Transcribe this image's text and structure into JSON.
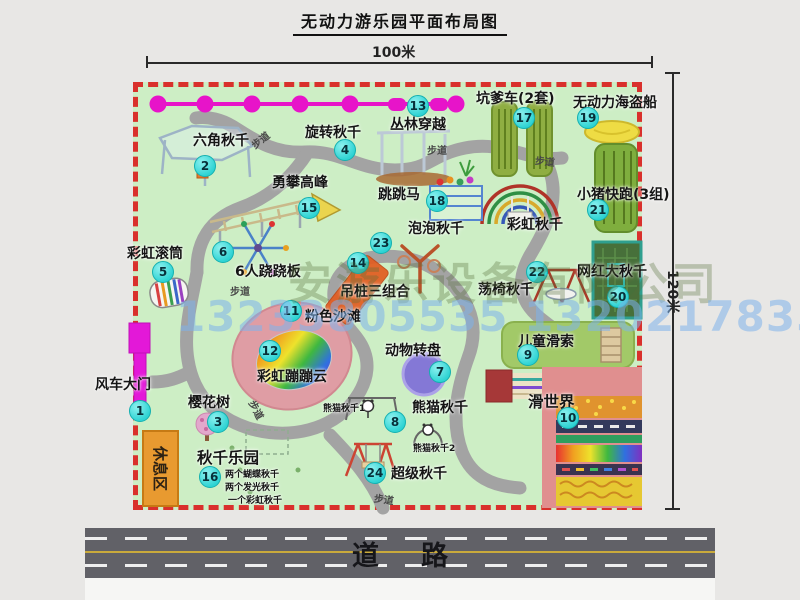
{
  "title": "无动力游乐园平面布局图",
  "dim_width": "100米",
  "dim_height": "120米",
  "road_label": "道路",
  "walkway_label": "步道",
  "rest_area_label": "休息区",
  "rainbow_swing_label": "彩虹秋千",
  "watermark": {
    "company": "安游乐设备有限公司",
    "phones": "13233805535 13202178333"
  },
  "swing_park_notes": [
    "两个蝴蝶秋千",
    "两个发光秋千",
    "一个彩虹秋千"
  ],
  "panda_swing_1": "熊猫秋千1",
  "panda_swing_2": "熊猫秋千2",
  "colors": {
    "map_green": "#cdeec5",
    "border_red": "#d9302c",
    "badge_cyan": "#2ed3d3",
    "gate_magenta": "#e318d8",
    "rest_orange": "#e89a30"
  },
  "attractions": [
    {
      "num": "1",
      "label": "风车大门"
    },
    {
      "num": "2",
      "label": "六角秋千"
    },
    {
      "num": "3",
      "label": "樱花树"
    },
    {
      "num": "4",
      "label": "旋转秋千"
    },
    {
      "num": "5",
      "label": "彩虹滚筒"
    },
    {
      "num": "6",
      "label": "6人跷跷板"
    },
    {
      "num": "7",
      "label": "动物转盘"
    },
    {
      "num": "8",
      "label": "熊猫秋千"
    },
    {
      "num": "9",
      "label": "儿童滑索"
    },
    {
      "num": "10",
      "label": "滑世界"
    },
    {
      "num": "11",
      "label": "粉色沙滩"
    },
    {
      "num": "12",
      "label": "彩虹蹦蹦云"
    },
    {
      "num": "13",
      "label": "丛林穿越"
    },
    {
      "num": "14",
      "label": "吊桩三组合"
    },
    {
      "num": "15",
      "label": "勇攀高峰"
    },
    {
      "num": "16",
      "label": "秋千乐园"
    },
    {
      "num": "17",
      "label": "坑爹车(2套)"
    },
    {
      "num": "18",
      "label": "跳跳马"
    },
    {
      "num": "19",
      "label": "无动力海盗船"
    },
    {
      "num": "20",
      "label": "网红大秋千"
    },
    {
      "num": "21",
      "label": "小猪快跑(3组)"
    },
    {
      "num": "22",
      "label": "荡椅秋千"
    },
    {
      "num": "23",
      "label": "泡泡秋千"
    },
    {
      "num": "24",
      "label": "超级秋千"
    }
  ]
}
